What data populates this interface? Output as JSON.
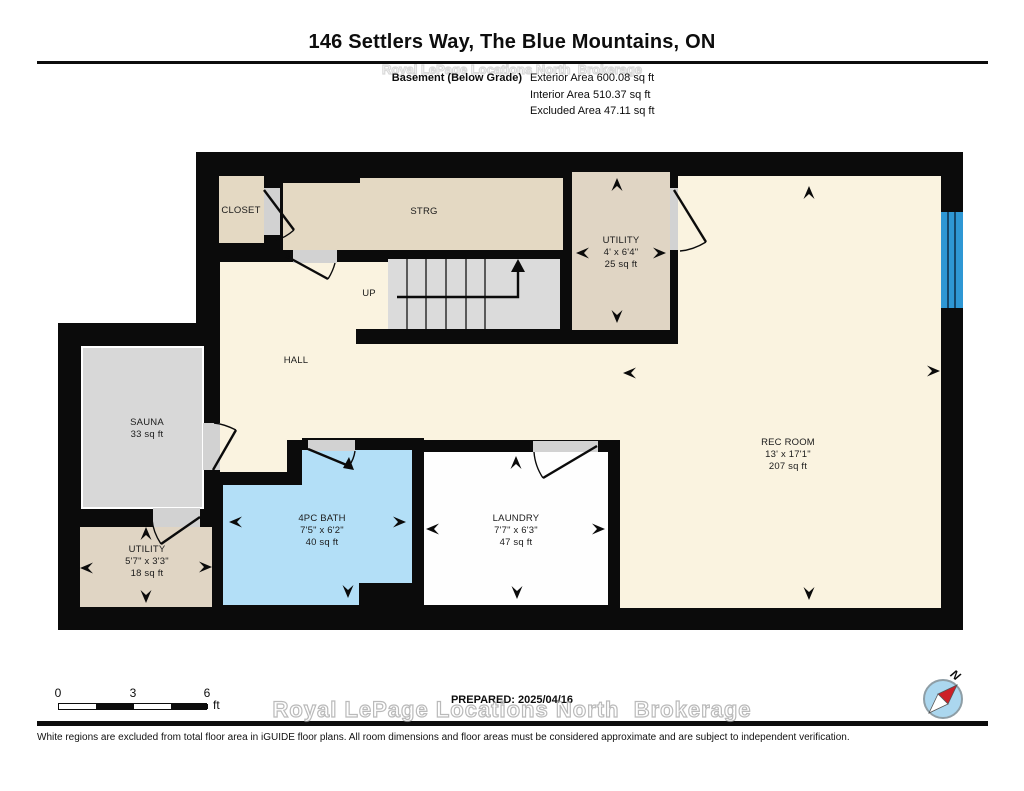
{
  "header": {
    "title": "146 Settlers Way, The Blue Mountains, ON",
    "floor_label": "Basement (Below Grade)",
    "areas": [
      "Exterior Area 600.08 sq ft",
      "Interior Area 510.37 sq ft",
      "Excluded Area 47.11 sq ft"
    ]
  },
  "rooms": {
    "closet": {
      "name": "CLOSET"
    },
    "strg": {
      "name": "STRG"
    },
    "stairs": {
      "direction_label": "UP"
    },
    "utility_top": {
      "name": "UTILITY",
      "dims": "4' x 6'4\"",
      "area": "25 sq ft"
    },
    "hall": {
      "name": "HALL"
    },
    "sauna": {
      "name": "SAUNA",
      "area": "33 sq ft"
    },
    "rec_room": {
      "name": "REC ROOM",
      "dims": "13' x 17'1\"",
      "area": "207 sq ft"
    },
    "bath": {
      "name": "4PC BATH",
      "dims": "7'5\" x 6'2\"",
      "area": "40 sq ft"
    },
    "laundry": {
      "name": "LAUNDRY",
      "dims": "7'7\" x 6'3\"",
      "area": "47 sq ft"
    },
    "utility_lower": {
      "name": "UTILITY",
      "dims": "5'7\" x 3'3\"",
      "area": "18 sq ft"
    }
  },
  "footer": {
    "scale_labels": [
      "0",
      "3",
      "6"
    ],
    "scale_unit": "ft",
    "prepared": "PREPARED: 2025/04/16",
    "compass_label": "N",
    "watermark": "Royal LePage Locations North  Brokerage",
    "disclaimer": "White regions are excluded from total floor area in iGUIDE floor plans. All room dimensions and floor areas must be considered approximate and are subject to independent verification."
  },
  "colors": {
    "wall": "#0b0b0b",
    "interior_cream": "#faf3e0",
    "excluded_tan": "#e4d9c3",
    "excluded_gray": "#d8d8d8",
    "door_gray": "#d2d2d2",
    "bath_blue": "#b3dff7",
    "window_blue": "#2e97d4",
    "laundry_white": "#fefefe"
  }
}
